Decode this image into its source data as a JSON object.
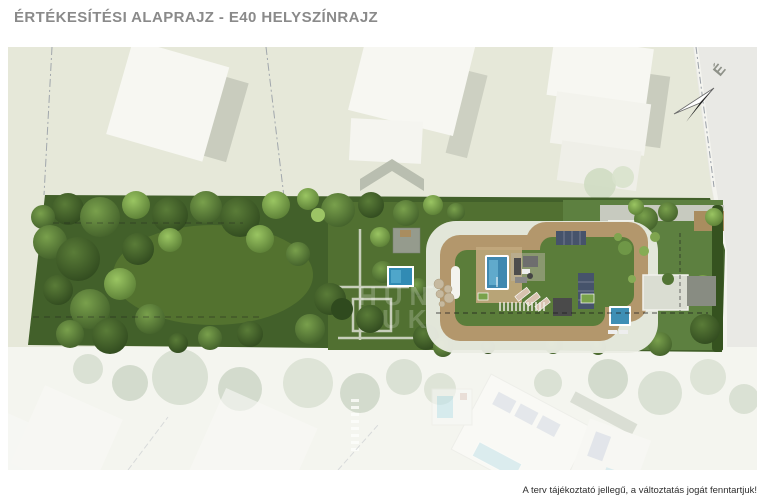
{
  "page": {
    "title": "ÉRTÉKESÍTÉSI ALAPRAJZ - E40 HELYSZÍNRAJZ",
    "disclaimer": "A terv tájékoztató jellegű, a változtatás jogát fenntartjuk!"
  },
  "plan": {
    "north_label": "É",
    "watermark_line1": "HUN",
    "watermark_line2": "UK"
  },
  "palette": {
    "ground": "#e6e8d9",
    "road": "#e9e9e5",
    "roof_white": "#f7f7f2",
    "property_green": "#42602a",
    "lawn": "#5d8040",
    "deck_tan": "#b3976c",
    "pool_blue": "#3e88b0",
    "solar_navy": "#46536b",
    "faded_pool": "#9fd4e2"
  }
}
